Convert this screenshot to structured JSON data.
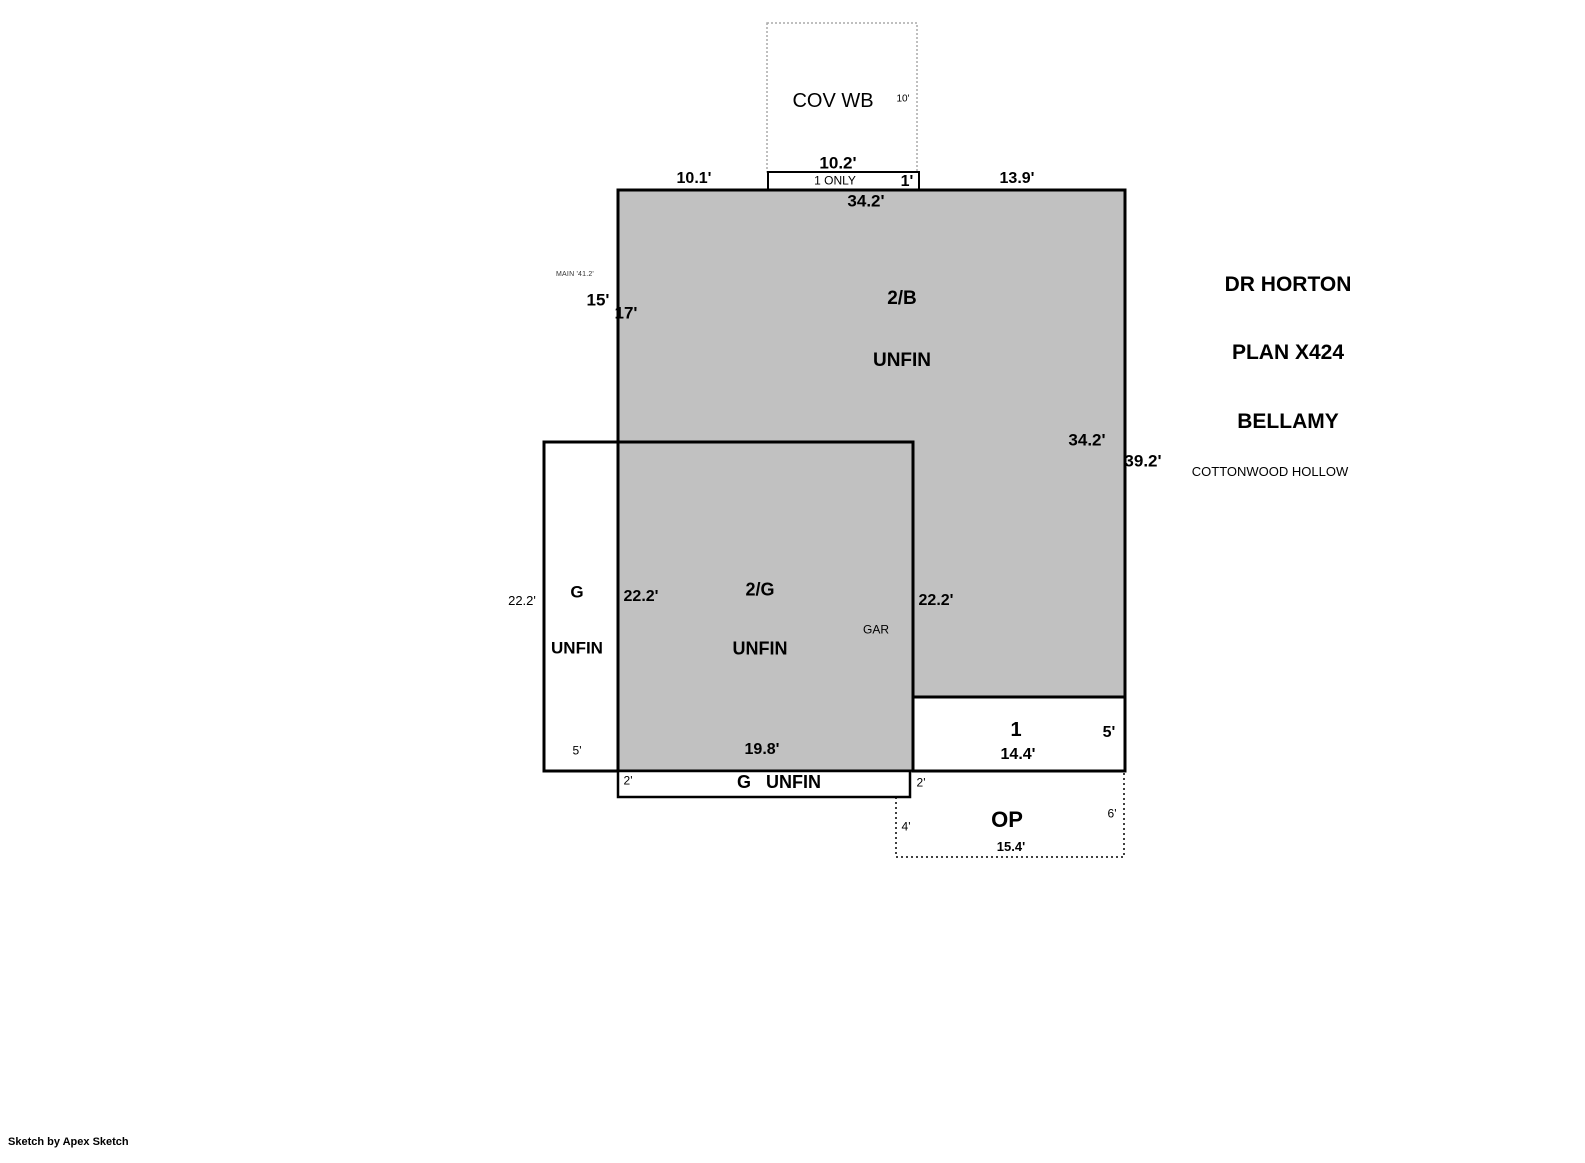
{
  "colors": {
    "area_fill": "#c1c1c1",
    "outline": "#000000",
    "cov_wb_border": "#aaaaaa"
  },
  "cov_wb": {
    "name": "COV WB",
    "depth": "10'",
    "width": "10.2'"
  },
  "one_only": {
    "name": "1 ONLY",
    "depth": "1'"
  },
  "upper_area": {
    "left_offset": "10.1'",
    "right_offset": "13.9'",
    "top_width": "34.2'",
    "note": "MAIN '41.2'",
    "left_outer_height": "15'",
    "left_inner_height": "17'",
    "room_line1": "2/B",
    "room_line2": "UNFIN",
    "right_inner_height": "34.2'",
    "right_outer_height": "39.2'"
  },
  "garage_area": {
    "outer_height": "22.2'",
    "col_line1": "G",
    "col_line2": "UNFIN",
    "inner_left_height": "22.2'",
    "room_line1": "2/G",
    "room_line2": "UNFIN",
    "gar_note": "GAR",
    "inner_right_height": "22.2'",
    "col_width": "5'",
    "bottom_width": "19.8'"
  },
  "strip_area": {
    "left_depth": "2'",
    "label": "G   UNFIN",
    "right_depth": "2'"
  },
  "porch_area": {
    "name": "1",
    "depth": "5'",
    "width": "14.4'"
  },
  "op_area": {
    "name": "OP",
    "left_depth": "4'",
    "right_depth": "6'",
    "width": "15.4'"
  },
  "title_block": {
    "line1": "DR HORTON",
    "line2": "PLAN X424",
    "line3": "BELLAMY",
    "subdivision": "COTTONWOOD HOLLOW"
  },
  "credit": "Sketch by Apex Sketch"
}
